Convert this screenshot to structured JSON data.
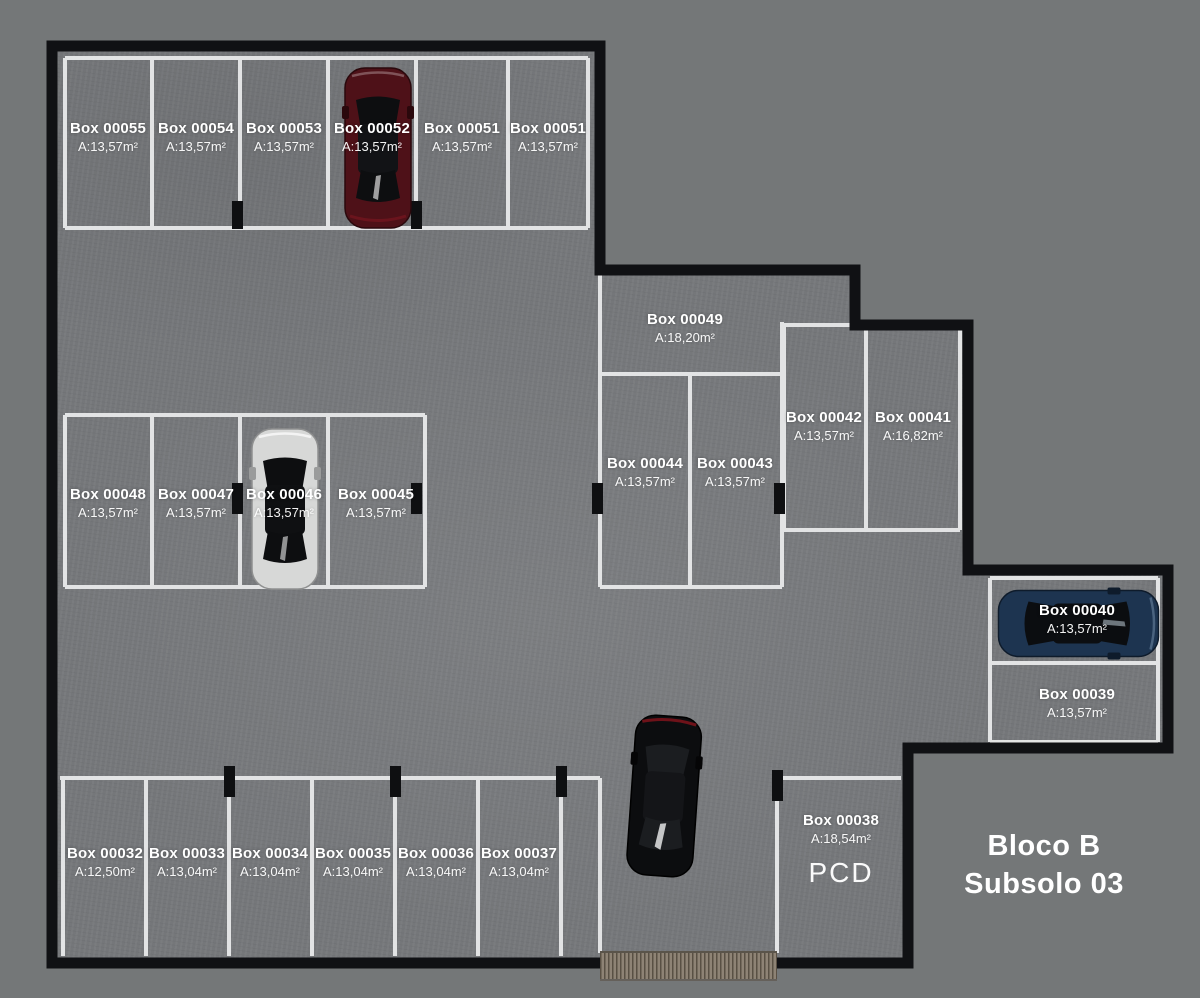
{
  "title": {
    "block": "Bloco B",
    "level": "Subsolo 03"
  },
  "stalls": {
    "s55": {
      "label": "Box 00055",
      "area": "A:13,57m²"
    },
    "s54": {
      "label": "Box 00054",
      "area": "A:13,57m²"
    },
    "s53": {
      "label": "Box 00053",
      "area": "A:13,57m²"
    },
    "s52": {
      "label": "Box 00052",
      "area": "A:13,57m²"
    },
    "s51a": {
      "label": "Box 00051",
      "area": "A:13,57m²"
    },
    "s51b": {
      "label": "Box 00051",
      "area": "A:13,57m²"
    },
    "s49": {
      "label": "Box 00049",
      "area": "A:18,20m²"
    },
    "s48": {
      "label": "Box 00048",
      "area": "A:13,57m²"
    },
    "s47": {
      "label": "Box 00047",
      "area": "A:13,57m²"
    },
    "s46": {
      "label": "Box 00046",
      "area": "A:13,57m²"
    },
    "s45": {
      "label": "Box 00045",
      "area": "A:13,57m²"
    },
    "s44": {
      "label": "Box 00044",
      "area": "A:13,57m²"
    },
    "s43": {
      "label": "Box 00043",
      "area": "A:13,57m²"
    },
    "s42": {
      "label": "Box 00042",
      "area": "A:13,57m²"
    },
    "s41": {
      "label": "Box 00041",
      "area": "A:16,82m²"
    },
    "s40": {
      "label": "Box 00040",
      "area": "A:13,57m²"
    },
    "s39": {
      "label": "Box 00039",
      "area": "A:13,57m²"
    },
    "s38": {
      "label": "Box 00038",
      "area": "A:18,54m²",
      "tag": "PCD"
    },
    "s37": {
      "label": "Box 00037",
      "area": "A:13,04m²"
    },
    "s36": {
      "label": "Box 00036",
      "area": "A:13,04m²"
    },
    "s35": {
      "label": "Box 00035",
      "area": "A:13,04m²"
    },
    "s34": {
      "label": "Box 00034",
      "area": "A:13,04m²"
    },
    "s33": {
      "label": "Box 00033",
      "area": "A:13,04m²"
    },
    "s32": {
      "label": "Box 00032",
      "area": "A:12,50m²"
    }
  },
  "cars": {
    "red": {
      "color": "#4e1118"
    },
    "white": {
      "color": "#d7d8d7"
    },
    "black": {
      "color": "#0c0d0f"
    },
    "blue": {
      "color": "#1d3450"
    }
  },
  "colors": {
    "background": "#747778",
    "floor": "#77797c",
    "wall": "#101114",
    "stall_line": "#e7e8e9",
    "ramp": "#8e8375"
  }
}
